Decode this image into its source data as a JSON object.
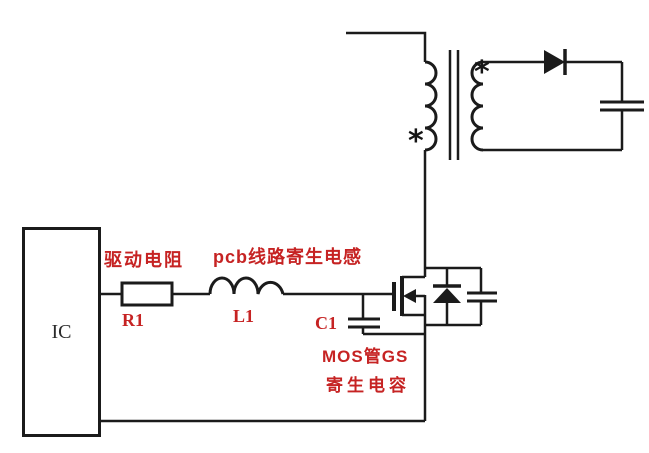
{
  "diagram": {
    "title_hint": "MOSFET gate drive parasitics circuit",
    "background": "#ffffff",
    "line_color": "#1b1b1b",
    "annotation_color": "#c62323",
    "text_color": "#2b2b2b"
  },
  "labels": {
    "ic": "IC",
    "r1": "R1",
    "l1": "L1",
    "c1": "C1"
  },
  "annotations": {
    "drive_resistor": "驱动电阻",
    "pcb_trace_parasitic_inductance": "pcb线路寄生电感",
    "mos_gs_line1": "MOS管GS",
    "mos_gs_line2": "寄生电容"
  },
  "symbols": {
    "primary_dot": "*",
    "secondary_dot": "*"
  }
}
